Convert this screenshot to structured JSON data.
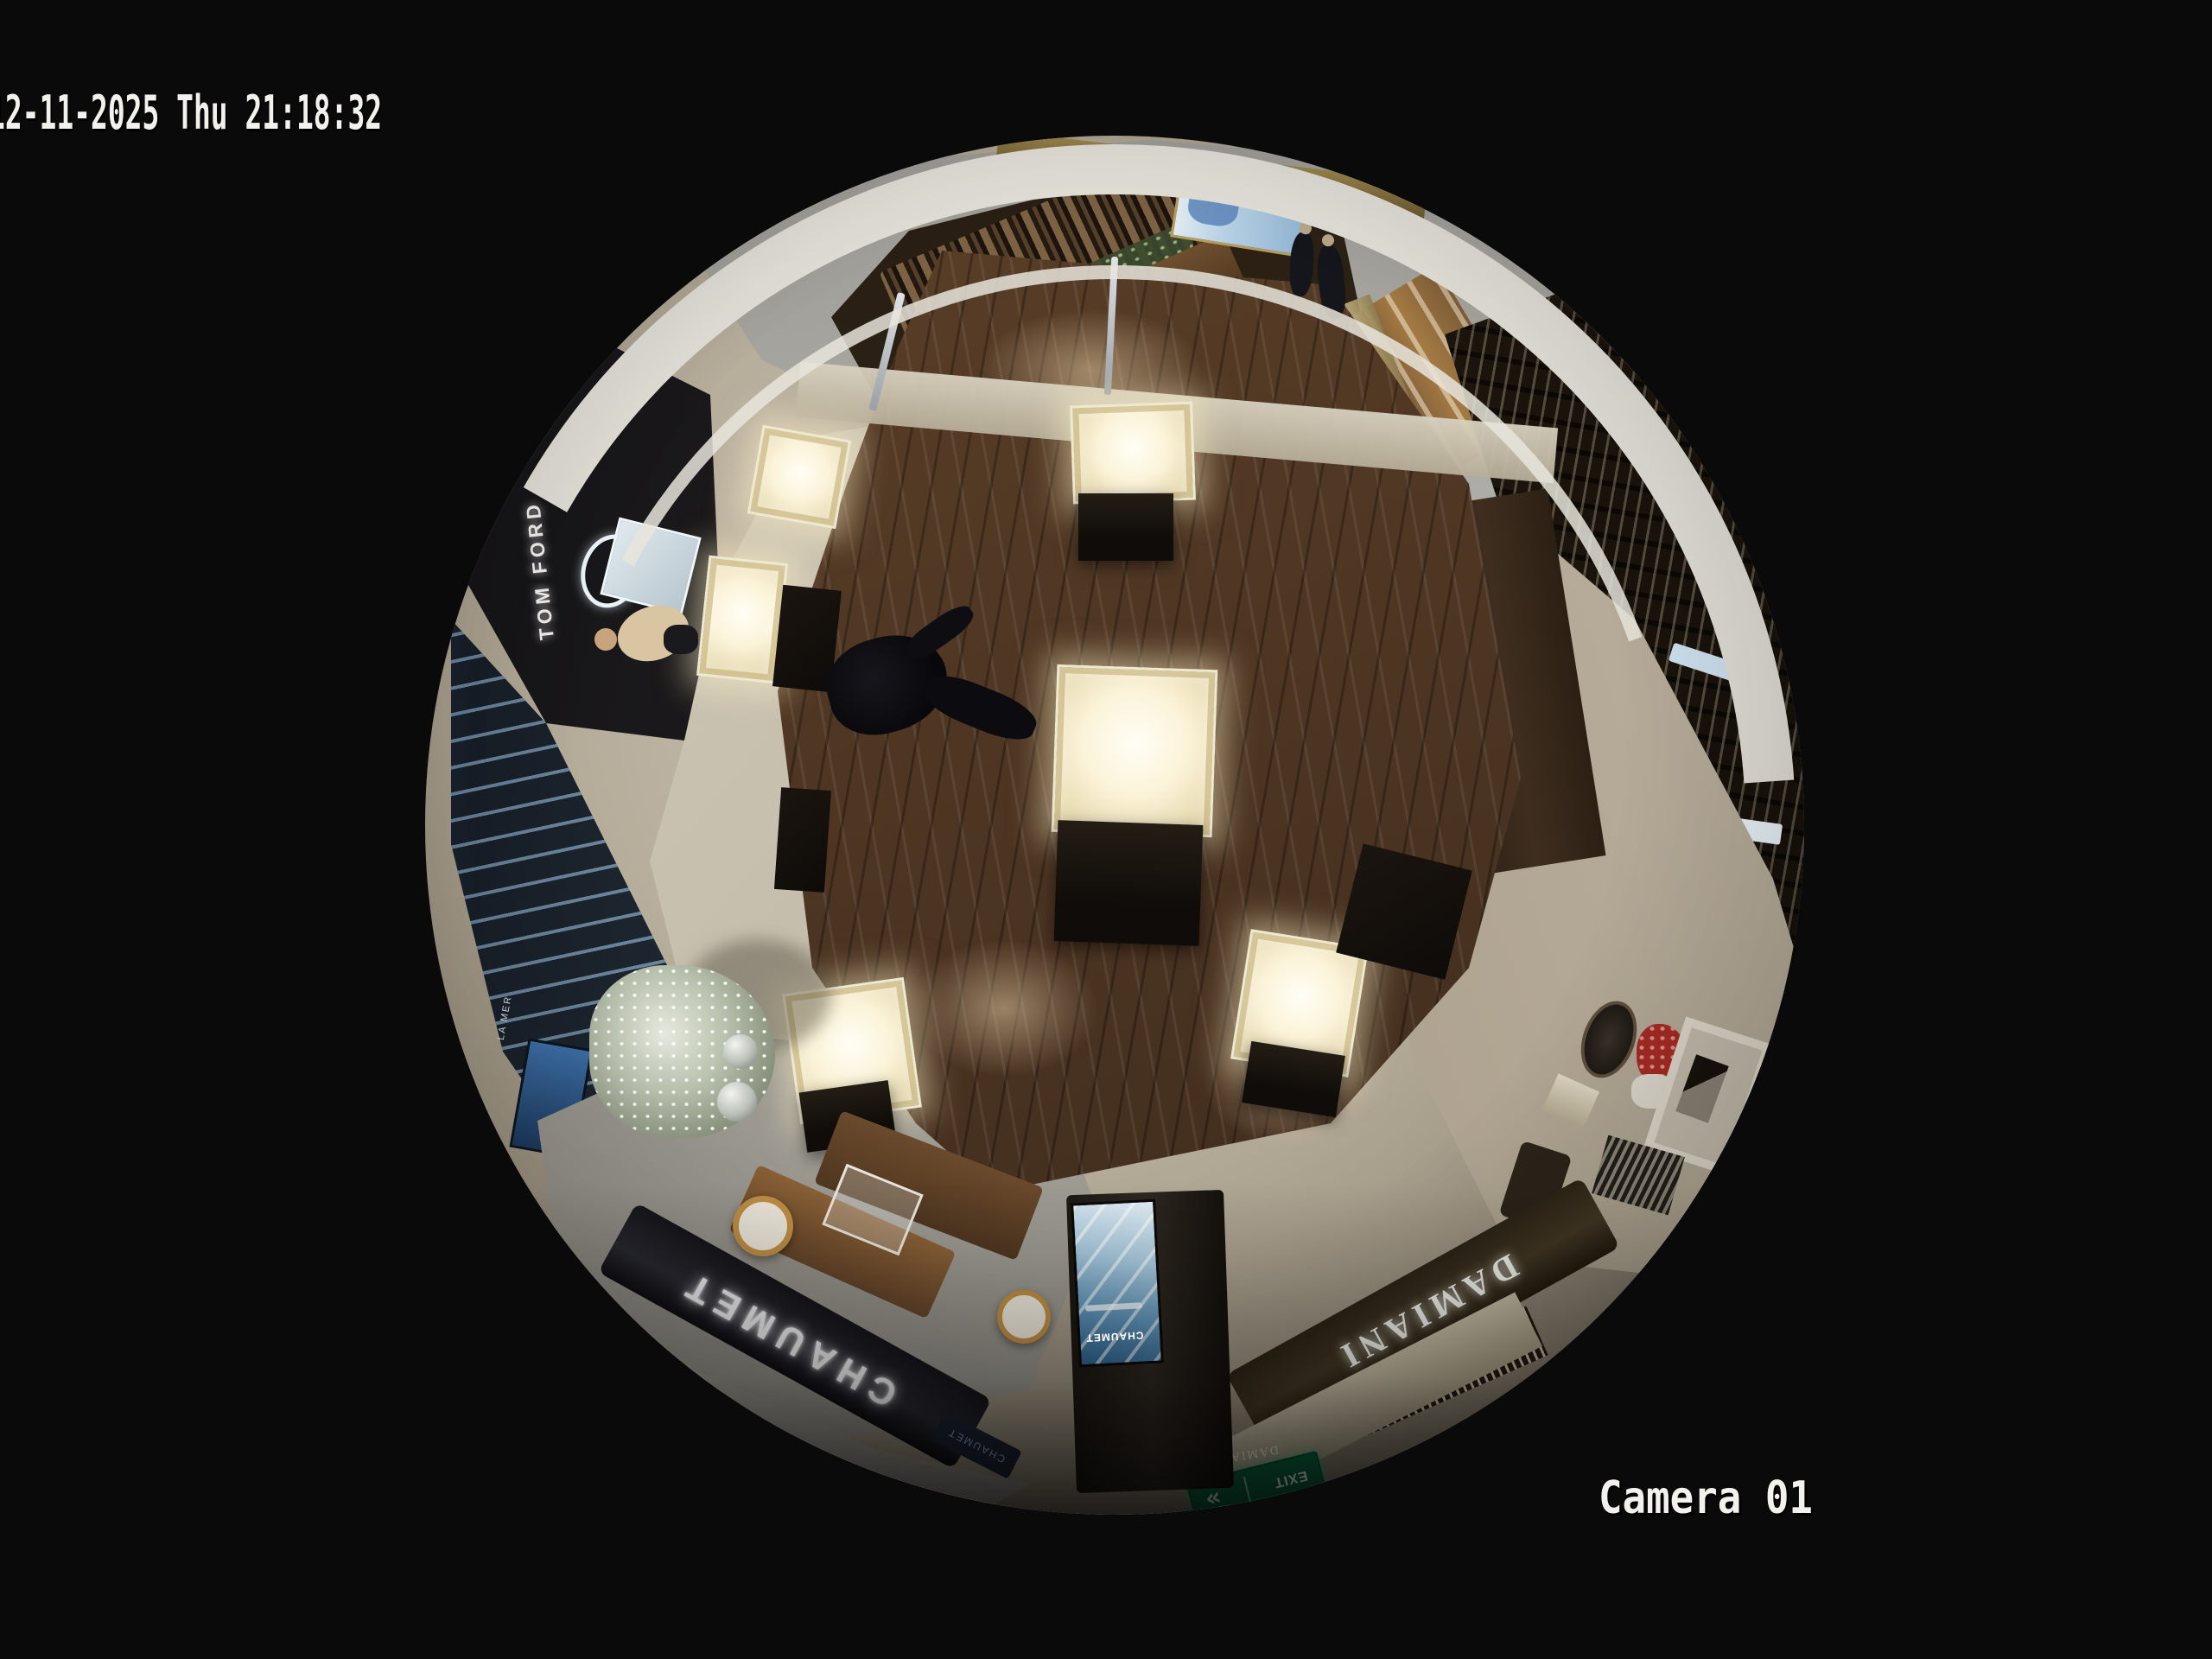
{
  "meta": {
    "view": "fisheye overhead CCTV frame",
    "scene": "luxury jewelry and beauty boutique atrium with mall corridor"
  },
  "osd": {
    "timestamp": "12-11-2025 Thu 21:18:32",
    "camera_label": "Camera 01"
  },
  "signs": {
    "tom_ford": "TOM FORD",
    "chaumet_fascia": "CHAUMET",
    "chaumet_totem_screen": "CHAUMET",
    "chaumet_mini_panel": "CHAUMET",
    "damiani_fascia": "DAMIANI",
    "damiani_mini": "DAMIANI",
    "exit_text": "EXIT",
    "exit_arrows": "«",
    "la_mer_shelf": "LA MER"
  },
  "colors": {
    "background": "#0a0a0a",
    "osd_text": "#f3f1ec",
    "wood_floor": "#4a3321",
    "corridor_marble": "#b4b2ac",
    "vitrine_glow": "#fdf8e4",
    "chaumet_fascia_bg": "#1d1d24",
    "damiani_fascia_bg": "#3a2f1f",
    "exit_green": "#0c6e44",
    "totem_screen_blue": "#5d93b8",
    "christmas_tree": "#b9c2ae",
    "flowers_red": "#a62c24"
  }
}
